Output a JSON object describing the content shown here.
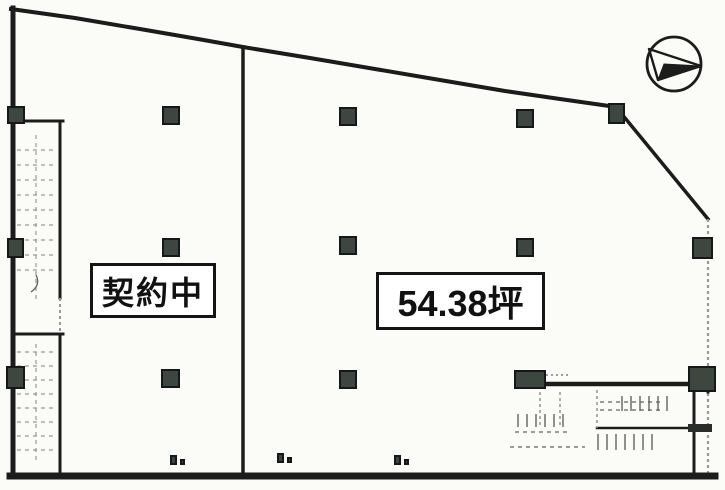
{
  "plan": {
    "kind": "floor-plan",
    "labels": {
      "left_unit": "契約中",
      "right_unit_area": "54.38坪"
    },
    "colors": {
      "background": "#fbfbf8",
      "wall": "#1c1c1c",
      "column": "#3d473f",
      "column_border": "#15181a",
      "faint": "#9a9a94",
      "label_bg": "#ffffff",
      "label_border": "#141414"
    },
    "icons": {
      "compass": "north-arrow-icon"
    },
    "columns": [
      {
        "x": 8,
        "y": 107,
        "w": 16,
        "h": 16
      },
      {
        "x": 163,
        "y": 107,
        "w": 16,
        "h": 17
      },
      {
        "x": 340,
        "y": 108,
        "w": 16,
        "h": 17
      },
      {
        "x": 517,
        "y": 110,
        "w": 16,
        "h": 17
      },
      {
        "x": 609,
        "y": 104,
        "w": 15,
        "h": 19
      },
      {
        "x": 8,
        "y": 239,
        "w": 15,
        "h": 18
      },
      {
        "x": 163,
        "y": 239,
        "w": 16,
        "h": 17
      },
      {
        "x": 340,
        "y": 237,
        "w": 16,
        "h": 17
      },
      {
        "x": 517,
        "y": 239,
        "w": 16,
        "h": 17
      },
      {
        "x": 693,
        "y": 238,
        "w": 19,
        "h": 20
      },
      {
        "x": 7,
        "y": 367,
        "w": 17,
        "h": 21
      },
      {
        "x": 162,
        "y": 370,
        "w": 17,
        "h": 17
      },
      {
        "x": 340,
        "y": 371,
        "w": 16,
        "h": 17
      },
      {
        "x": 515,
        "y": 371,
        "w": 30,
        "h": 17
      },
      {
        "x": 689,
        "y": 367,
        "w": 26,
        "h": 24
      },
      {
        "x": 171,
        "y": 456,
        "w": 5,
        "h": 8
      },
      {
        "x": 181,
        "y": 460,
        "w": 3,
        "h": 4
      },
      {
        "x": 278,
        "y": 454,
        "w": 5,
        "h": 8
      },
      {
        "x": 288,
        "y": 458,
        "w": 3,
        "h": 4
      },
      {
        "x": 395,
        "y": 456,
        "w": 5,
        "h": 8
      },
      {
        "x": 405,
        "y": 460,
        "w": 3,
        "h": 4
      }
    ]
  }
}
